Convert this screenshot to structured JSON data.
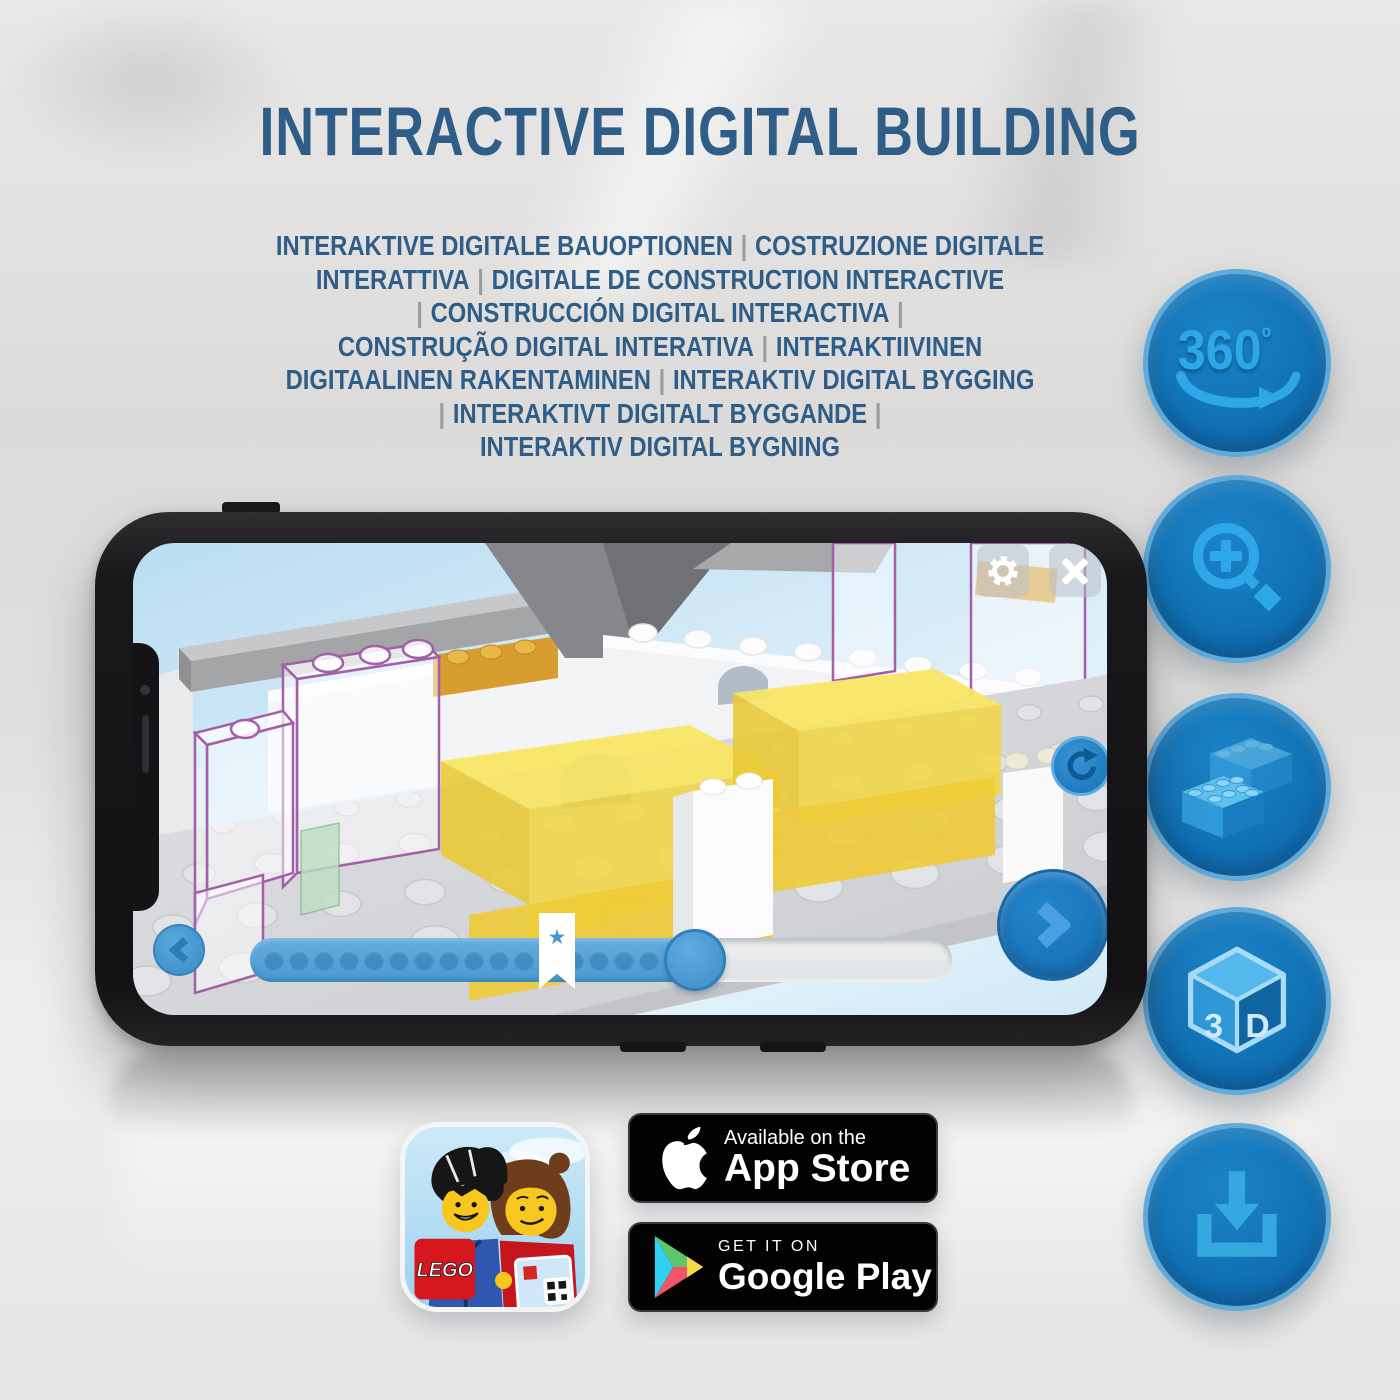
{
  "header": {
    "title": "INTERACTIVE DIGITAL BUILDING",
    "subtitle_lines": [
      "INTERAKTIVE DIGITALE BAUOPTIONEN | COSTRUZIONE DIGITALE",
      "INTERATTIVA | DIGITALE DE CONSTRUCTION INTERACTIVE",
      "| CONSTRUCCIÓN DIGITAL INTERACTIVA |",
      "CONSTRUÇÃO DIGITAL INTERATIVA | INTERAKTIIVINEN",
      "DIGITAALINEN RAKENTAMINEN | INTERAKTIV DIGITAL BYGGING",
      "| INTERAKTIVT DIGITALT BYGGANDE |",
      "INTERAKTIV DIGITAL BYGNING"
    ]
  },
  "features": [
    {
      "id": "rotation-360",
      "label": "360",
      "degree_symbol": "º"
    },
    {
      "id": "zoom-in"
    },
    {
      "id": "brick-building"
    },
    {
      "id": "view-3d",
      "face_left": "3",
      "face_right": "D"
    },
    {
      "id": "download"
    }
  ],
  "phone_app": {
    "icons": [
      "gear-icon",
      "close-icon",
      "rotate-reset-icon",
      "previous-step-icon",
      "next-step-icon",
      "bookmark-star-icon"
    ],
    "bookmark_star_glyph": "★",
    "progress": {
      "dot_count": 17,
      "progress_percent": 64,
      "bookmark_percent": 44
    }
  },
  "store_badges": {
    "app_store": {
      "tagline": "Available on the",
      "store_name": "App Store"
    },
    "google_play": {
      "tagline": "GET IT ON",
      "store_name": "Google Play"
    }
  },
  "lego_app_icon": {
    "logo_text": "LEGO"
  },
  "colors": {
    "heading_blue": "#2e5e88",
    "separator_gray": "#9b9b9b",
    "feature_circle_blue": "#1173b6",
    "feature_glyph_blue": "#2ea7e6",
    "app_accent_blue": "#4c9ed8",
    "lego_yellow": "#f2d741",
    "ghost_outline_purple": "#a35fa9",
    "badge_black": "#030303"
  }
}
